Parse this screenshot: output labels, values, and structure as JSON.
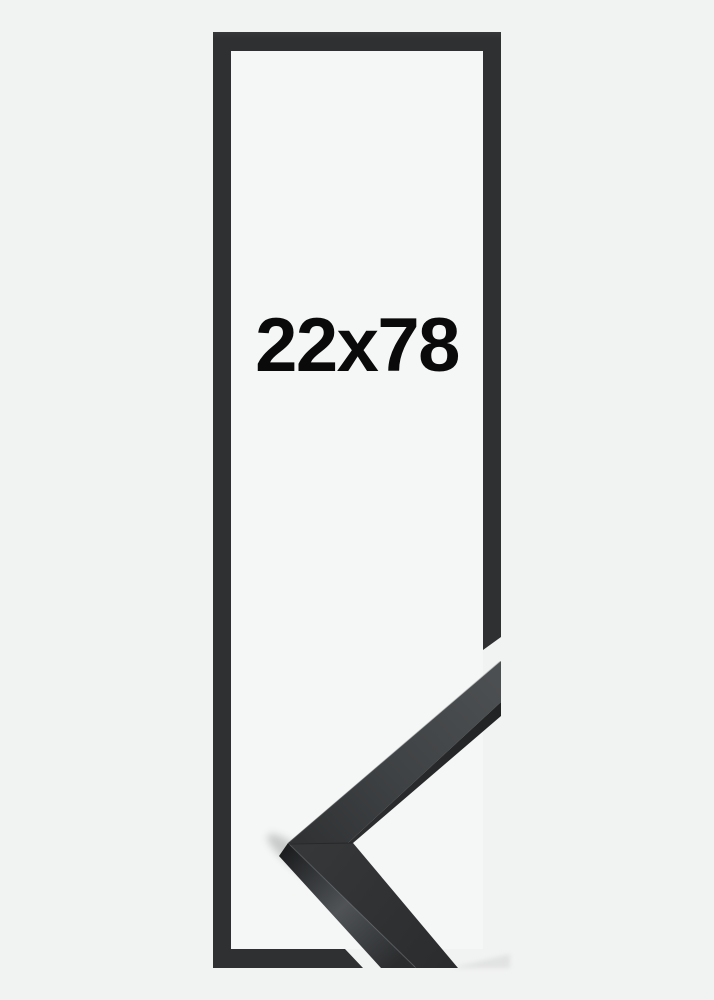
{
  "frame_product": {
    "size_label": "22x78"
  },
  "colors": {
    "background": "#f1f2f2",
    "inner_background": "#f5f6f6",
    "frame": "#2e3032",
    "frame_dark_edge": "#232527",
    "frame_face_light": "#4b4e50",
    "label_text": "#0a0a0a"
  }
}
